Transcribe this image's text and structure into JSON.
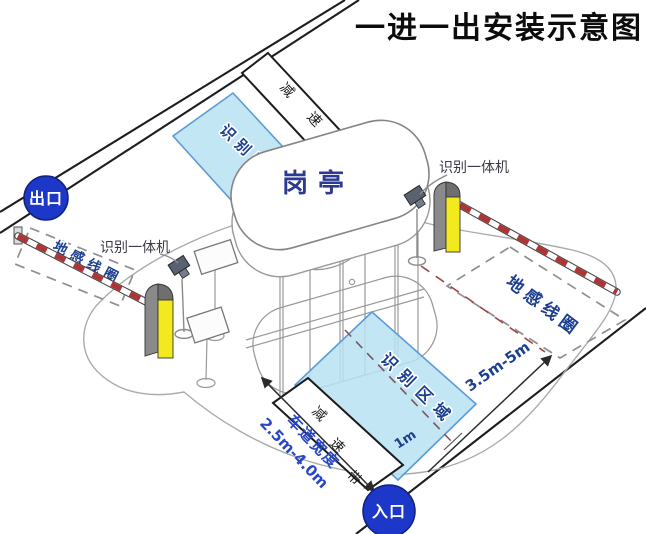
{
  "title": "一进一出安装示意图",
  "badges": {
    "exit": "出口",
    "entrance": "入口"
  },
  "booth": {
    "label": "岗亭"
  },
  "equipment": {
    "camera_left_label": "识别一体机",
    "camera_right_label": "识别一体机"
  },
  "zones": {
    "recognition_top": "识别区域",
    "recognition_bottom": "识别区域",
    "loop_left": "地感线圈",
    "loop_right": "地感线圈"
  },
  "speed_bumps": {
    "top": "减速带",
    "bottom_chars": [
      "减",
      "速",
      "带"
    ]
  },
  "dimensions": {
    "lane_width_title": "车道宽度",
    "lane_width_range": "2.5m-4.0m",
    "loop_distance": "3.5m-5m",
    "center_offset": "1m"
  },
  "colors": {
    "zone_fill": "#b9e2f3",
    "zone_border": "#5b9bd5",
    "badge_blue": "#1d37c8",
    "barrier_red": "#b03434",
    "post_yellow": "#f2ea1f",
    "label_navy": "#1c3f8f",
    "lane_blue": "#2746c8"
  }
}
